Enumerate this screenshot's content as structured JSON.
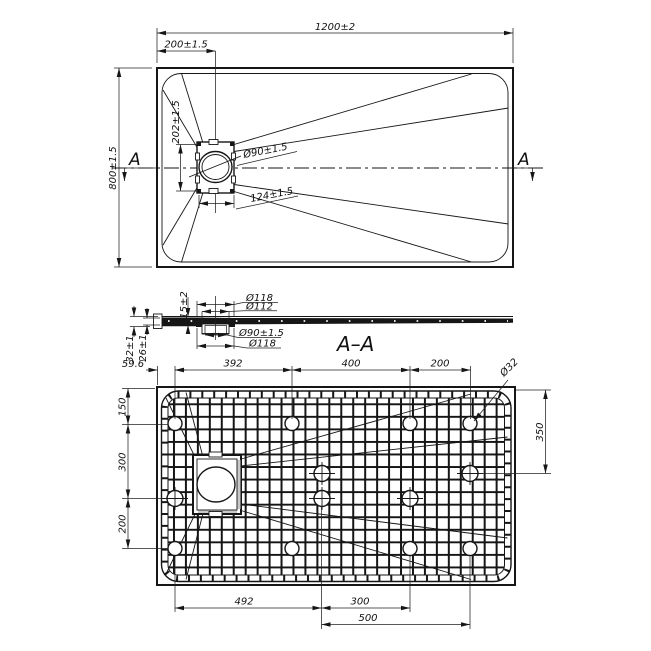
{
  "colors": {
    "ink": "#161616",
    "background": "#ffffff"
  },
  "top_view": {
    "width_dim": "1200±2",
    "drain_x_dim": "200±1.5",
    "height_dim": "800±1.5",
    "drain_h_dim": "202±1.5",
    "drain_dia_dim": "Ø90±1.5",
    "drain_w_dim": "124±1.5",
    "section_letter": "A"
  },
  "section_view": {
    "title": "A–A",
    "flange_top_dim": "Ø118",
    "collar_dim": "Ø112",
    "hole_dim": "Ø90±1.5",
    "flange_bottom_dim": "Ø118",
    "depth_dim": "15±2",
    "outer_h_dim": "32±1",
    "inner_h_dim": "26±1"
  },
  "bottom_view": {
    "top_dims": [
      "59.6",
      "392",
      "400",
      "200"
    ],
    "foot_dia_dim": "Ø32",
    "left_dims": [
      "150",
      "300",
      "200"
    ],
    "right_dim": "350",
    "bottom_dims": [
      "492",
      "300",
      "500"
    ]
  }
}
